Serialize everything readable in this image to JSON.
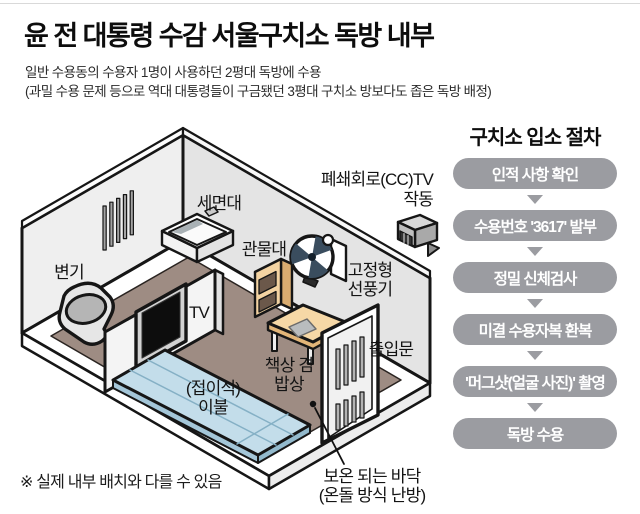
{
  "header": {
    "title": "윤 전 대통령 수감 서울구치소 독방 내부",
    "subtitle_line1": "일반 수용동의 수용자 1명이 사용하던 2평대 독방에 수용",
    "subtitle_line2": "(과밀 수용 문제 등으로 역대 대통령들이 구금됐던 3평대 구치소 방보다도 좁은 독방 배정)"
  },
  "procedure": {
    "title": "구치소 입소 절차",
    "steps": [
      "인적 사항 확인",
      "수용번호 '3617' 발부",
      "정밀 신체검사",
      "미결 수용자복 환복",
      "'머그샷(얼굴 사진)' 촬영",
      "독방 수용"
    ]
  },
  "room": {
    "labels": {
      "sink": "세면대",
      "cctv_line1": "폐쇄회로(CC)TV",
      "cctv_line2": "작동",
      "toilet": "변기",
      "locker": "관물대",
      "fan_line1": "고정형",
      "fan_line2": "선풍기",
      "tv": "TV",
      "door": "출입문",
      "bedding_line1": "(접이식)",
      "bedding_line2": "이불",
      "desk_line1": "책상 겸",
      "desk_line2": "밥상",
      "floor_line1": "보온 되는 바닥",
      "floor_line2": "(온돌 방식 난방)"
    },
    "note": "※ 실제 내부 배치와 다를 수 있음"
  },
  "colors": {
    "step_pill": "#9b9ca1",
    "floor_brown": "#9e8c83",
    "wall_gray": "#ececec",
    "mattress_blue": "#c3ddea",
    "furniture_tan": "#f6d8a6",
    "outline": "#161616"
  }
}
